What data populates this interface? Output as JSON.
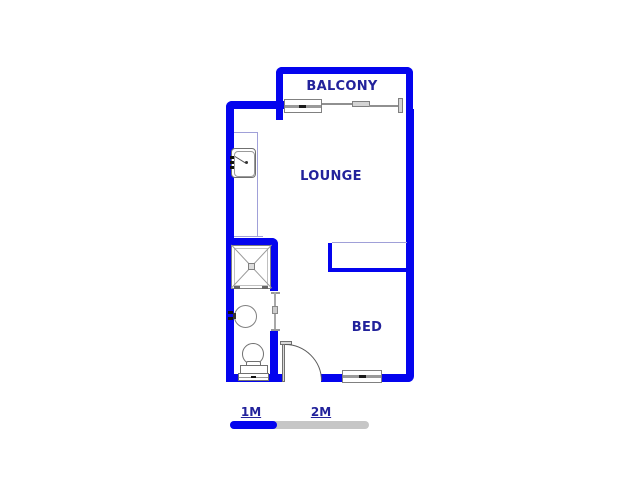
{
  "title": "Floor plan",
  "rooms": [
    {
      "label": "BALCONY"
    },
    {
      "label": "LOUNGE"
    },
    {
      "label": "BED"
    }
  ],
  "scale_bar": {
    "labels": [
      "1M",
      "2M"
    ]
  },
  "fixtures": [
    "kitchen-sink",
    "shower",
    "basin",
    "toilet",
    "entrance-door",
    "bathroom-door",
    "balcony-window",
    "bed-window",
    "sliding-door",
    "built-in-cupboard",
    "kitchen-counter"
  ],
  "colors": {
    "wall": "#0404ee",
    "label": "#22229b",
    "counter": "#a0a0d8",
    "fixture": "#808080",
    "scaleGray": "#c6c6c6"
  }
}
